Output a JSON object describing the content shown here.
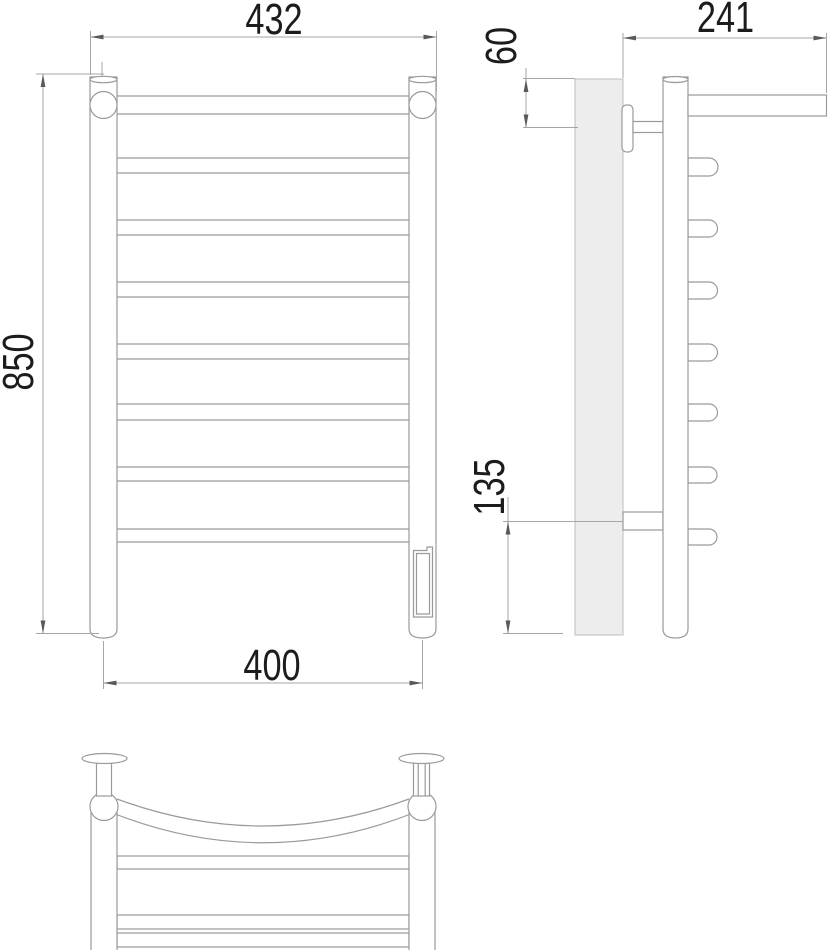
{
  "drawing": {
    "title": "Ladder towel rail technical drawing, three orthographic views",
    "views": [
      {
        "id": "front",
        "label": "front view"
      },
      {
        "id": "side",
        "label": "side view"
      },
      {
        "id": "bottom",
        "label": "bottom view"
      }
    ],
    "dimensions": {
      "overall_width": {
        "value": "432",
        "view": "front",
        "orientation": "horizontal"
      },
      "overall_height": {
        "value": "850",
        "view": "front",
        "orientation": "vertical"
      },
      "mounting_width": {
        "value": "400",
        "view": "front",
        "orientation": "horizontal"
      },
      "top_mount_offset": {
        "value": "60",
        "view": "side",
        "orientation": "vertical"
      },
      "overall_depth": {
        "value": "241",
        "view": "side",
        "orientation": "horizontal"
      },
      "bottom_mount_offset": {
        "value": "135",
        "view": "side",
        "orientation": "vertical"
      }
    },
    "colors": {
      "background": "#ffffff",
      "line": "#9a9a9a",
      "dim_line": "#a6a6a6",
      "arrow": "#595959",
      "text": "#1c1c1c",
      "wall_fill": "#ededed"
    }
  }
}
